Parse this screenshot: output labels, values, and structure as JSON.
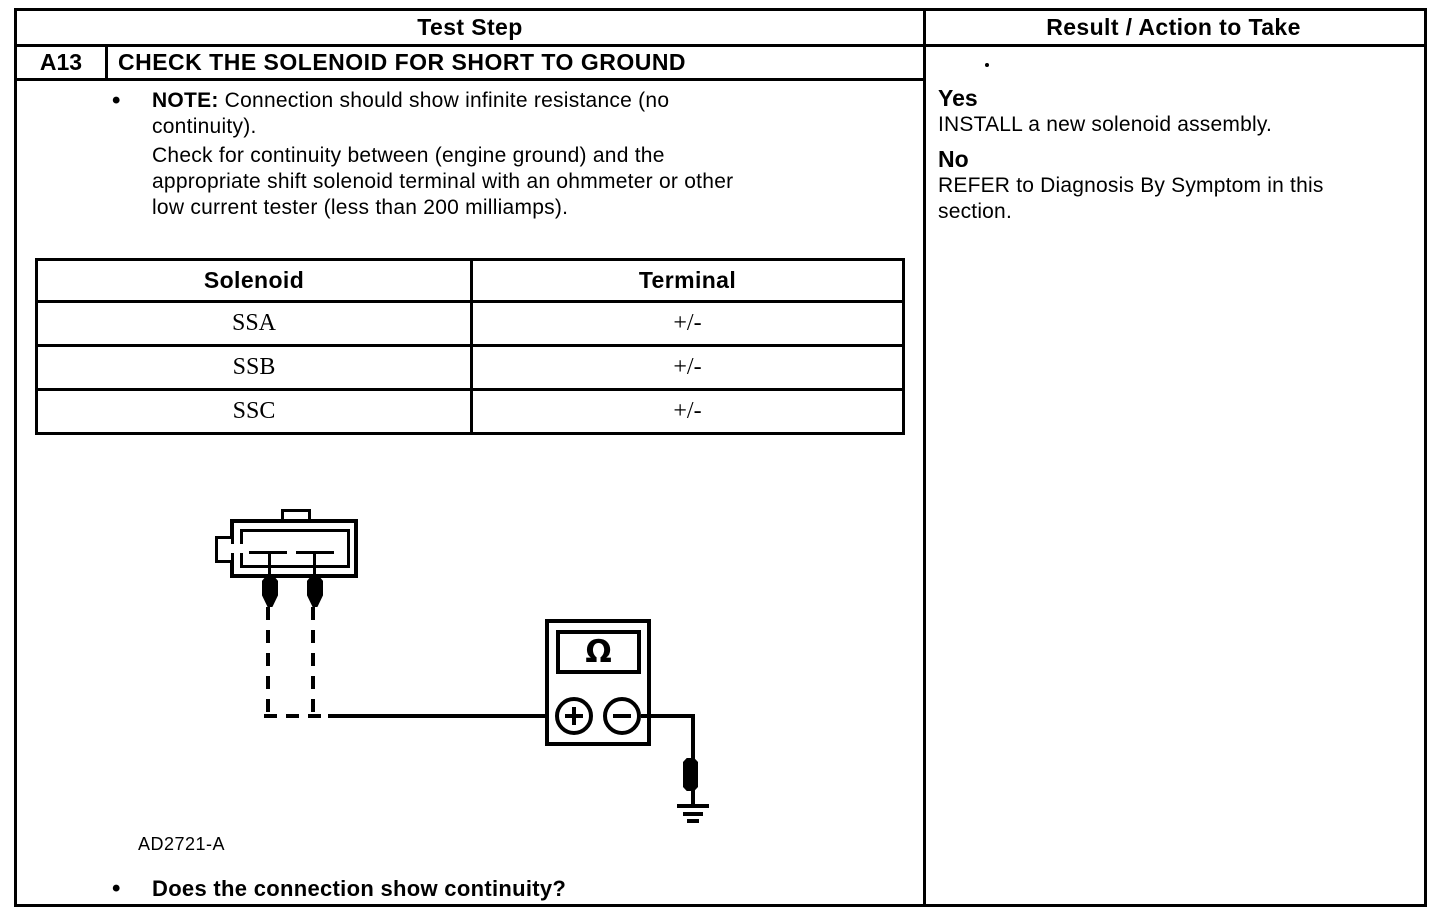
{
  "header": {
    "test_step": "Test Step",
    "result_action": "Result / Action to Take"
  },
  "step": {
    "id": "A13",
    "title": "CHECK THE SOLENOID FOR SHORT TO GROUND"
  },
  "note": {
    "bullet": "•",
    "label": "NOTE:",
    "text": "Connection should show infinite resistance (no\ncontinuity).",
    "instruction": "Check for continuity between (engine ground) and the\nappropriate shift solenoid terminal with an ohmmeter or other\nlow current tester (less than 200 milliamps)."
  },
  "solenoid_table": {
    "headers": [
      "Solenoid",
      "Terminal"
    ],
    "rows": [
      {
        "solenoid": "SSA",
        "terminal": "+/-"
      },
      {
        "solenoid": "SSB",
        "terminal": "+/-"
      },
      {
        "solenoid": "SSC",
        "terminal": "+/-"
      }
    ]
  },
  "diagram": {
    "meter_symbol": "Ω",
    "figure_id": "AD2721-A"
  },
  "question": {
    "bullet": "•",
    "text": "Does the connection show continuity?"
  },
  "result": {
    "yes_label": "Yes",
    "yes_action": "INSTALL a new solenoid assembly.",
    "no_label": "No",
    "no_action": "REFER to Diagnosis By Symptom in this\nsection."
  },
  "colors": {
    "ink": "#000000",
    "paper": "#ffffff"
  }
}
